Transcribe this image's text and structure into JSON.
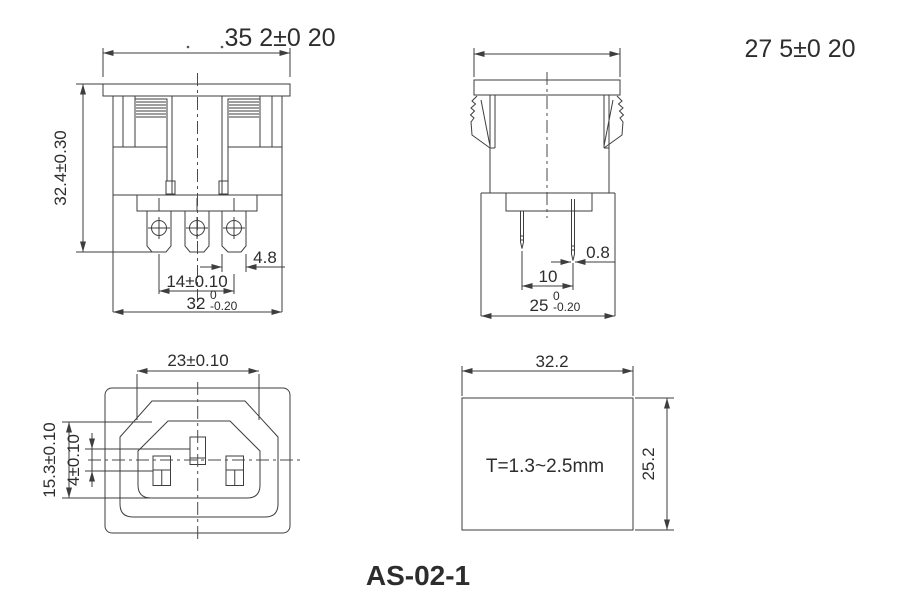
{
  "drawing": {
    "title": "AS-02-1",
    "front_view": {
      "flange_width": "35 2±0 20",
      "overall_height": "32.4±0.30",
      "terminal_width": "4.8",
      "terminal_spacing": "14±0.10",
      "body_width_value": "32",
      "body_width_tol_upper": "0",
      "body_width_tol_lower": "-0.20"
    },
    "side_view": {
      "flange_width": "27 5±0 20",
      "pin_thickness": "0.8",
      "pin_spacing": "10",
      "body_width_value": "25",
      "body_width_tol_upper": "0",
      "body_width_tol_lower": "-0.20"
    },
    "face_view": {
      "opening_width": "23±0.10",
      "opening_height": "15.3±0.10",
      "pin_offset": "4±0.10"
    },
    "panel_cutout": {
      "width": "32.2",
      "height": "25.2",
      "panel_thickness": "T=1.3~2.5mm"
    }
  }
}
